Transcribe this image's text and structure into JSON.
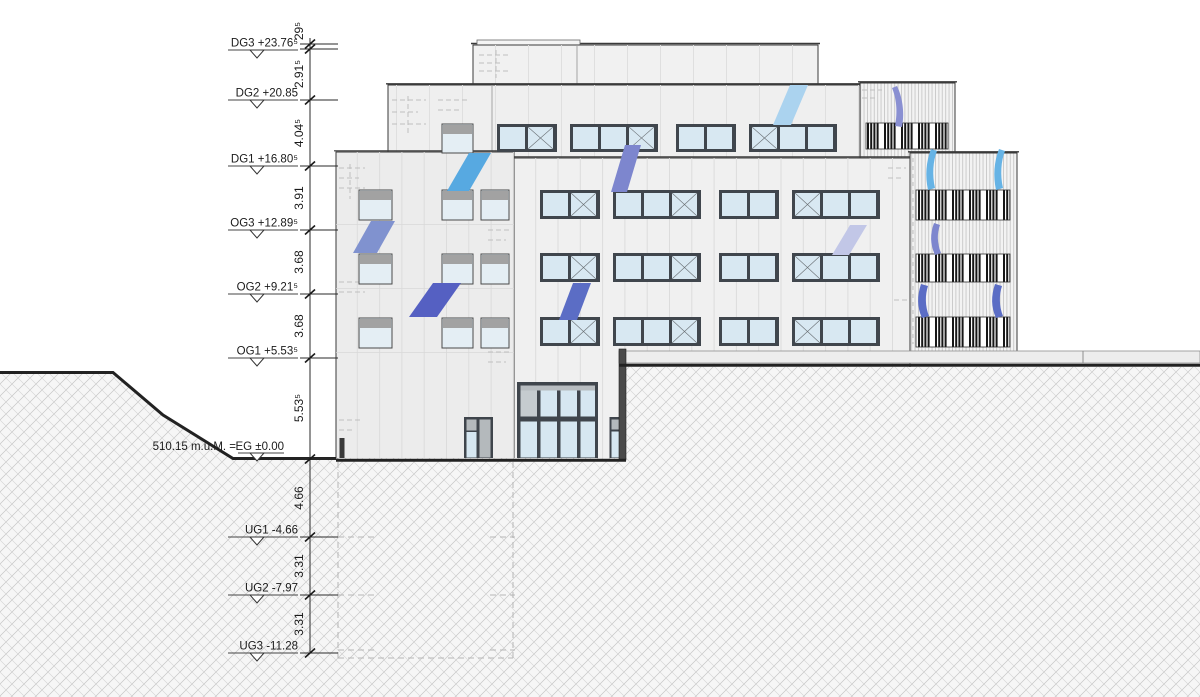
{
  "drawing": {
    "type": "architectural-section-elevation",
    "ground_annotation": "510.15 m.ü.M. =",
    "levels": [
      {
        "name": "DG3",
        "label": "DG3 +23.76⁵"
      },
      {
        "name": "DG2",
        "label": "DG2 +20.85"
      },
      {
        "name": "DG1",
        "label": "DG1 +16.80⁵"
      },
      {
        "name": "OG3",
        "label": "OG3 +12.89⁵"
      },
      {
        "name": "OG2",
        "label": "OG2 +9.21⁵"
      },
      {
        "name": "OG1",
        "label": "OG1 +5.53⁵"
      },
      {
        "name": "EG",
        "label": "EG ±0.00"
      },
      {
        "name": "UG1",
        "label": "UG1 -4.66"
      },
      {
        "name": "UG2",
        "label": "UG2 -7.97"
      },
      {
        "name": "UG3",
        "label": "UG3 -11.28"
      }
    ],
    "dimensions": [
      {
        "label": "29⁵"
      },
      {
        "label": "2.91⁵"
      },
      {
        "label": "4.04⁵"
      },
      {
        "label": "3.91"
      },
      {
        "label": "3.68"
      },
      {
        "label": "3.68"
      },
      {
        "label": "5.53⁵"
      },
      {
        "label": "4.66"
      },
      {
        "label": "3.31"
      },
      {
        "label": "3.31"
      }
    ],
    "colors": {
      "line": "#3a3a3a",
      "glass": "#d8e8f2",
      "window_frame": "#40464d",
      "ribbon_sky": "#57a9e1",
      "ribbon_periwinkle": "#8092cf",
      "ribbon_dark_blue": "#5560c2",
      "ribbon_blue": "#5b6dc5",
      "ribbon_pale_sky": "#abd3ef",
      "ribbon_lavender": "#c2c7e7"
    },
    "facade": {
      "ribbon_rows": [
        {
          "y": 124,
          "h": 28,
          "x0": 497,
          "x1": 830
        },
        {
          "y": 190,
          "h": 29,
          "x0": 540,
          "x1": 906
        },
        {
          "y": 253,
          "h": 29,
          "x0": 540,
          "x1": 906
        },
        {
          "y": 317,
          "h": 29,
          "x0": 540,
          "x1": 906
        }
      ],
      "punched_windows": {
        "rows_y": [
          191,
          255,
          319
        ],
        "cols": [
          {
            "x": 360,
            "w": 31
          },
          {
            "x": 443,
            "w": 29
          },
          {
            "x": 482,
            "w": 26
          }
        ],
        "h": 28,
        "extra": [
          {
            "x": 443,
            "y": 125,
            "w": 29,
            "h": 27
          }
        ]
      },
      "louver_bands": [
        {
          "x": 866,
          "y": 123,
          "w": 82,
          "h": 26
        },
        {
          "x": 916,
          "y": 190,
          "w": 94,
          "h": 30
        },
        {
          "x": 916,
          "y": 254,
          "w": 94,
          "h": 28
        },
        {
          "x": 916,
          "y": 317,
          "w": 94,
          "h": 30
        }
      ],
      "ribbons": [
        {
          "kind": "poly",
          "color": "#57a9e1",
          "points": "469,153 491,153 469,191 447,191"
        },
        {
          "kind": "poly",
          "color": "#8092cf",
          "points": "371,221 395,221 377,253 353,253"
        },
        {
          "kind": "poly",
          "color": "#5560c2",
          "points": "433,283 461,283 437,317 409,317"
        },
        {
          "kind": "poly",
          "color": "#7d86ce",
          "points": "625,145 641,145 627,192 611,192"
        },
        {
          "kind": "poly",
          "color": "#abd3ef",
          "points": "790,85 808,85 791,125 773,125"
        },
        {
          "kind": "poly",
          "color": "#c2c7e7",
          "points": "850,225 867,225 849,255 832,255"
        },
        {
          "kind": "poly",
          "color": "#5b6dc5",
          "points": "573,283 591,283 577,320 559,320"
        },
        {
          "kind": "path",
          "color": "#8a90d2",
          "d": "M897,86 C902,96 905,112 902,127 L895,126 C898,111 896,97 892,88 Z"
        },
        {
          "kind": "path",
          "color": "#66b3e5",
          "d": "M931,149 C926,162 925,176 928,190 L935,188 C932,175 933,161 937,151 Z"
        },
        {
          "kind": "path",
          "color": "#66b3e5",
          "d": "M999,149 C994,162 993,176 996,190 L1003,188 C1000,175 1001,161 1005,151 Z"
        },
        {
          "kind": "path",
          "color": "#7d86ce",
          "d": "M934,223 C930,234 930,244 935,255 L941,253 C937,243 937,233 940,225 Z"
        },
        {
          "kind": "path",
          "color": "#5b6dc5",
          "d": "M921,284 C917,296 917,307 922,318 L929,316 C925,306 925,295 928,286 Z"
        },
        {
          "kind": "path",
          "color": "#5b6dc5",
          "d": "M995,284 C991,296 991,307 996,318 L1003,316 C999,306 999,295 1002,286 Z"
        }
      ]
    }
  }
}
